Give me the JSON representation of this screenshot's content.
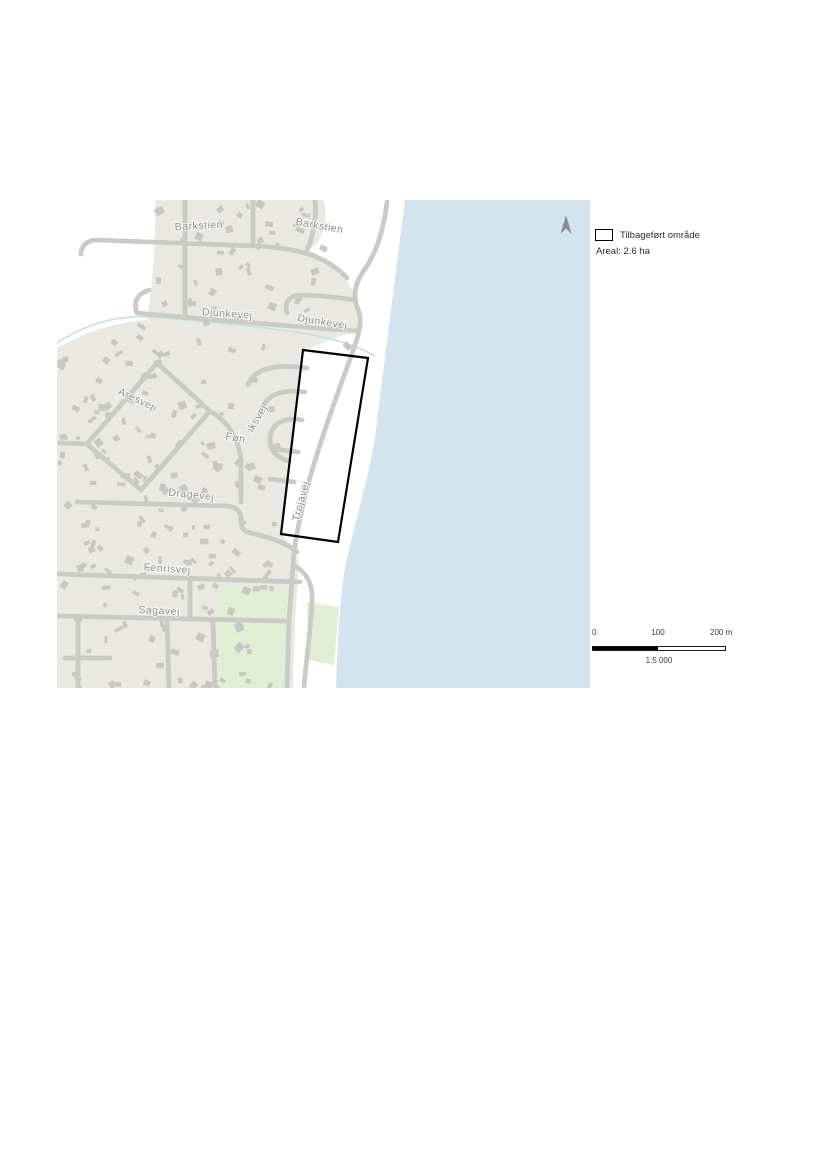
{
  "map": {
    "colors": {
      "water": "#d4e4ee",
      "land": "#e9e8e3",
      "green": "#e1eed3",
      "building": "#c8c7c2",
      "road_casing": "#cbcbc6",
      "road_fill": "#ffffff",
      "stream": "#c4e1dc",
      "street_label": "#8e8e8b",
      "boundary_outline": "#000000",
      "north_arrow": "#868b94"
    },
    "street_labels": [
      {
        "text": "Barkstien",
        "cx": 142,
        "cy": 29,
        "rot": -3
      },
      {
        "text": "Barkstien",
        "cx": 262,
        "cy": 29,
        "rot": 10
      },
      {
        "text": "Djunkevej",
        "cx": 170,
        "cy": 117,
        "rot": 4
      },
      {
        "text": "Djunkevej",
        "cx": 265,
        "cy": 125,
        "rot": 9
      },
      {
        "text": "Aresvej",
        "cx": 78,
        "cy": 202,
        "rot": 25
      },
      {
        "text": "Føn",
        "cx": 178,
        "cy": 241,
        "rot": 10
      },
      {
        "text": "iksvej",
        "cx": 203,
        "cy": 220,
        "rot": -60
      },
      {
        "text": "Dragevej",
        "cx": 134,
        "cy": 298,
        "rot": 6
      },
      {
        "text": "Trojavej",
        "cx": 247,
        "cy": 302,
        "rot": -75
      },
      {
        "text": "Fenrisvej",
        "cx": 110,
        "cy": 372,
        "rot": 4
      },
      {
        "text": "Sagavej",
        "cx": 102,
        "cy": 414,
        "rot": 3
      }
    ]
  },
  "legend": {
    "item_label": "Tilbageført område",
    "area_label": "Areal: 2.6 ha"
  },
  "scalebar": {
    "tick_0": "0",
    "tick_100": "100",
    "tick_200": "200 m",
    "ratio": "1:5 000"
  }
}
